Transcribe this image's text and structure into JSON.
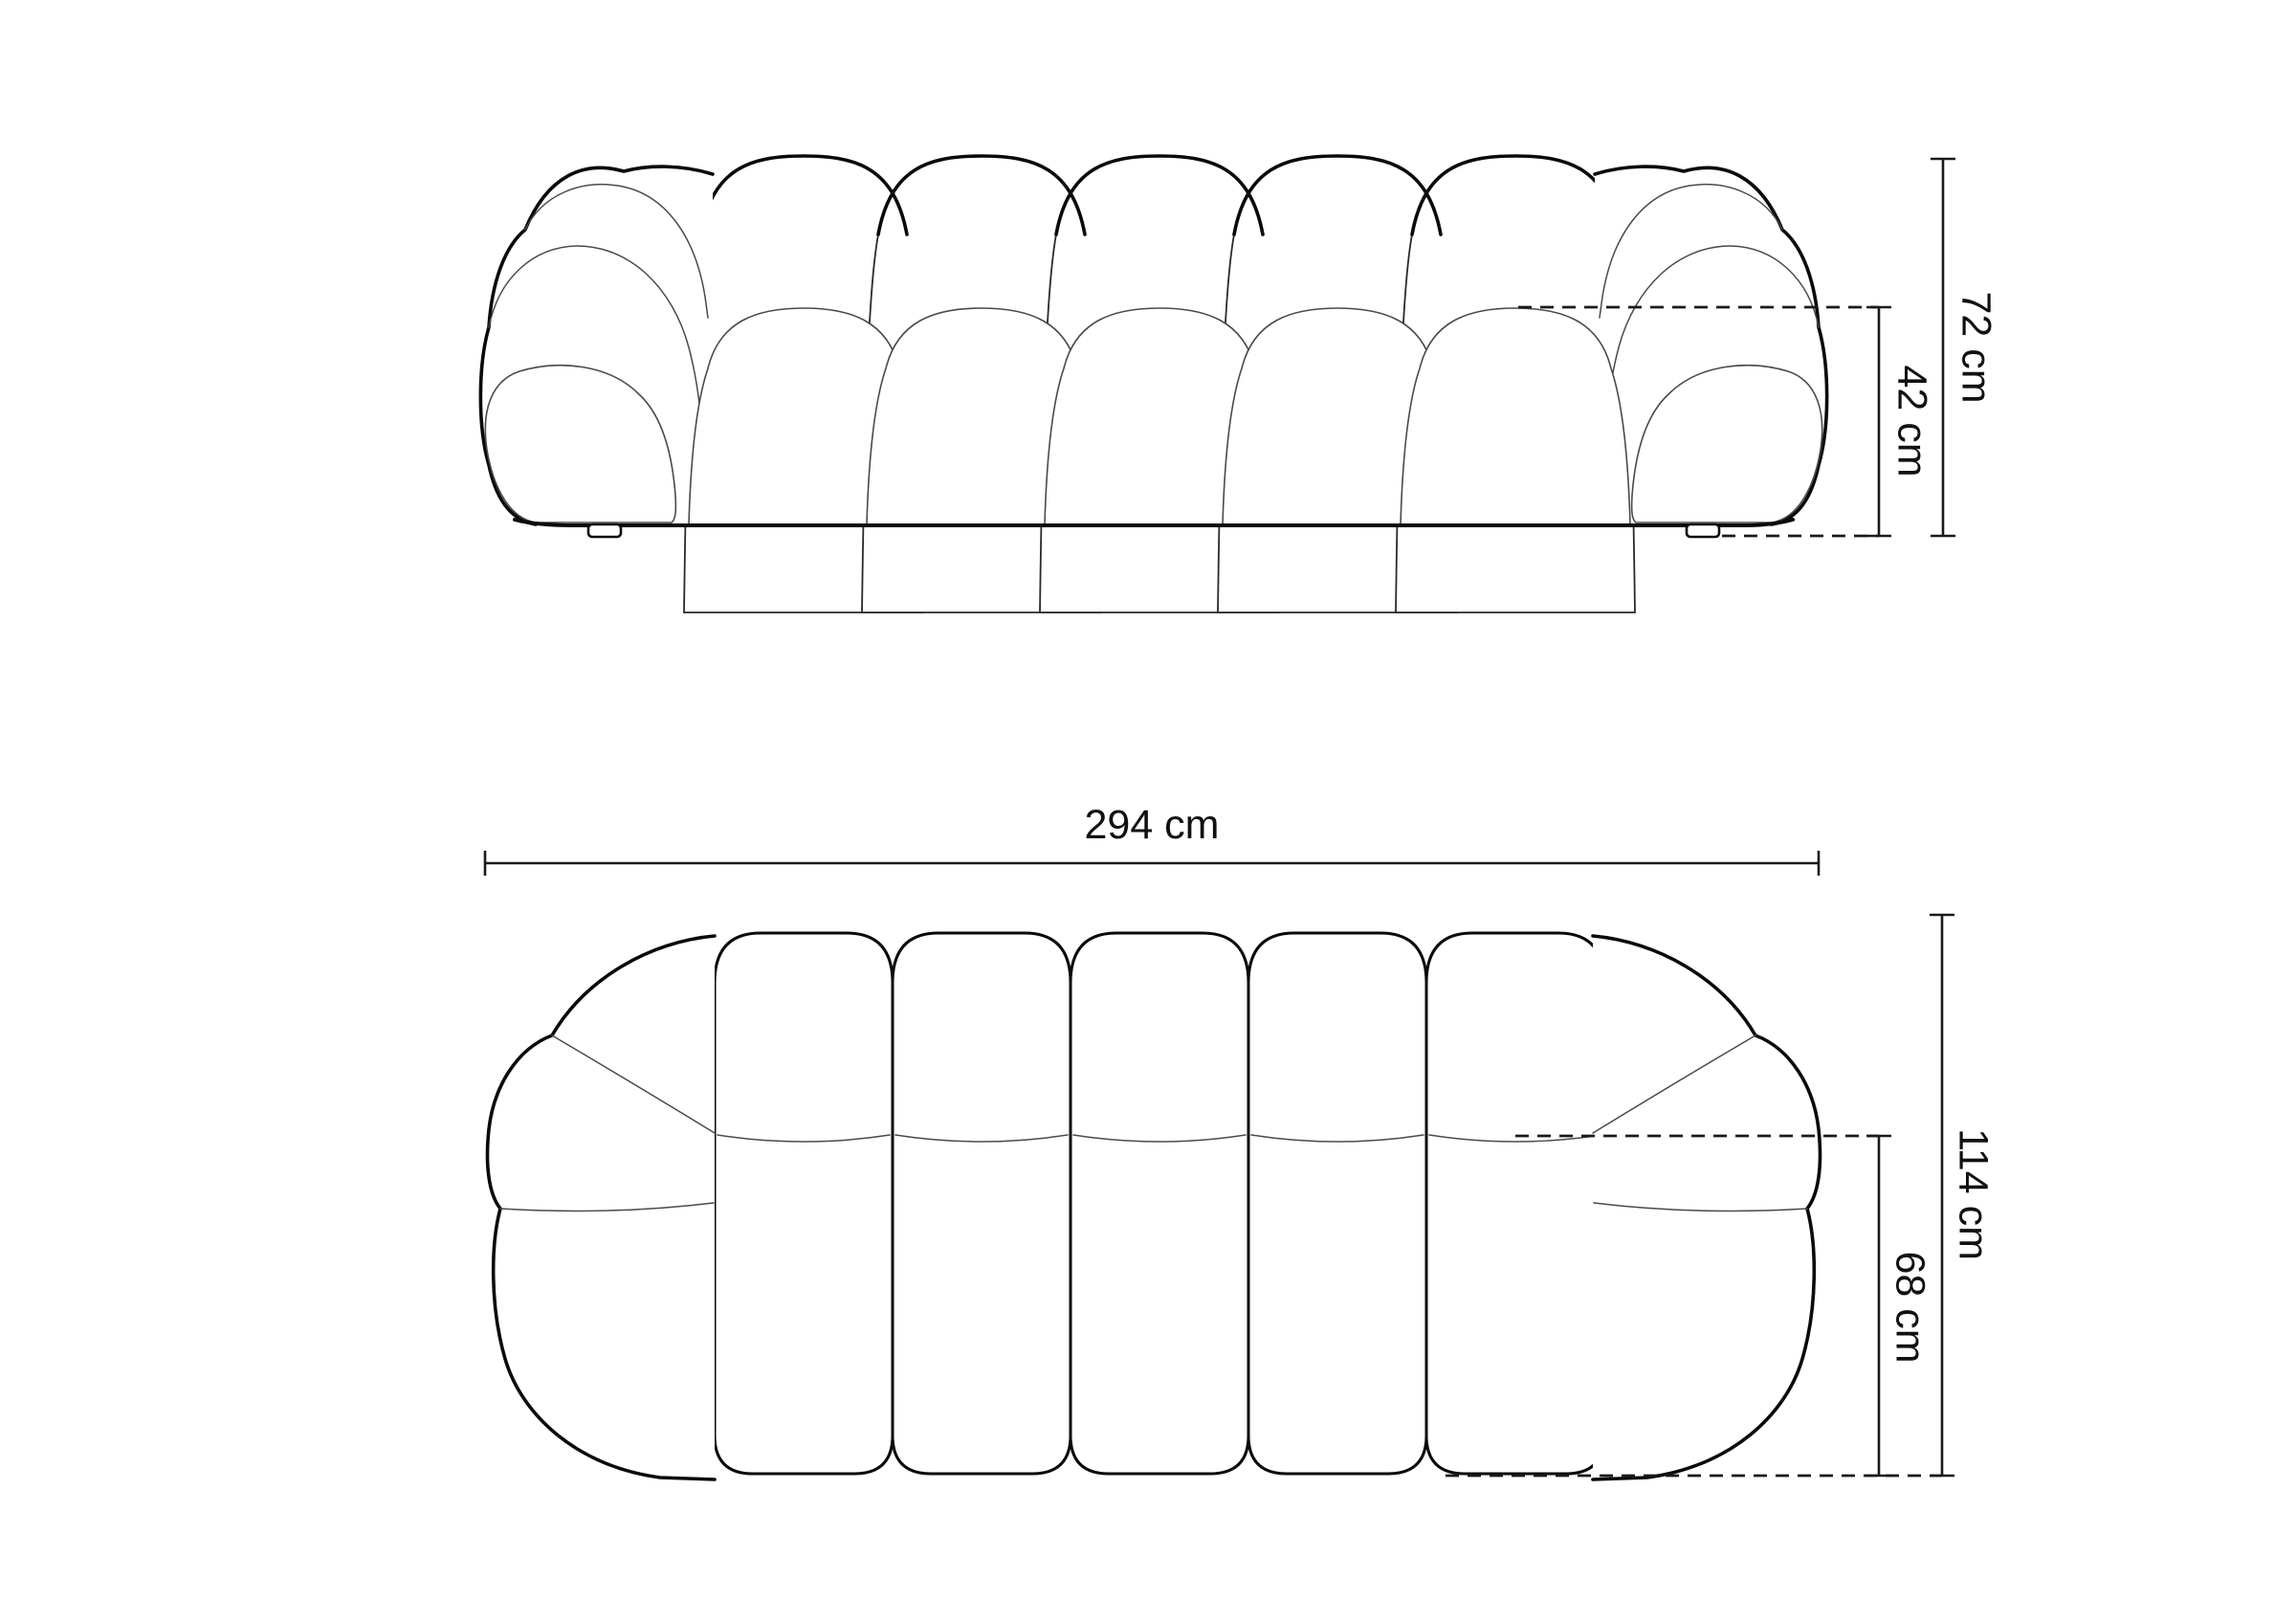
{
  "diagram": {
    "front_view": {
      "overall_height_label": "72 cm",
      "seat_height_label": "42 cm"
    },
    "top_view": {
      "overall_width_label": "294 cm",
      "overall_depth_label": "114 cm",
      "seat_depth_label": "68 cm"
    },
    "colors": {
      "background": "#ffffff",
      "line_heavy": "#0a0a0a",
      "line_thin": "#4a4a4a",
      "text": "#111111"
    }
  }
}
